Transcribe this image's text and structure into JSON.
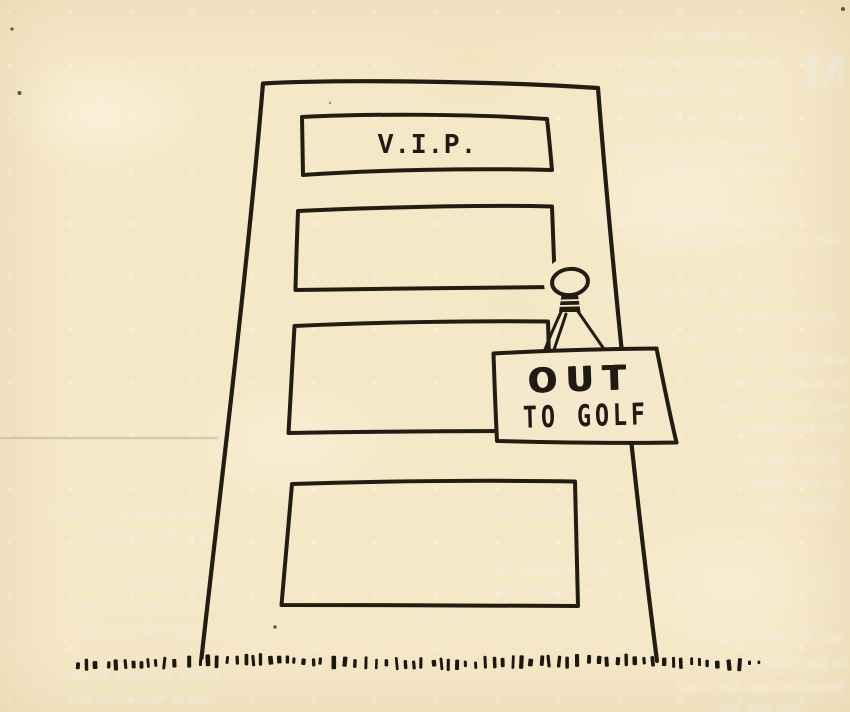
{
  "colors": {
    "paper": "#f5e8c7",
    "ink": "#221d14"
  },
  "door": {
    "vip_plate_label": "V.I.P.",
    "sign_line1": "OUT",
    "sign_line2": "TO GOLF",
    "panels_count": 4
  },
  "ghost_text": {
    "illegible": true,
    "big_letter": "M",
    "lines": [
      {
        "x": 598,
        "y": 28,
        "w": 150,
        "t": "um dem nach"
      },
      {
        "x": 612,
        "y": 54,
        "w": 168,
        "t": "geneinen versprinst"
      },
      {
        "x": 578,
        "y": 82,
        "w": 162,
        "t": "dep Vereing Beh"
      },
      {
        "x": 596,
        "y": 110,
        "w": 182,
        "t": "wenn ihr am Ein"
      },
      {
        "x": 576,
        "y": 138,
        "w": 225,
        "t": "gewohnt. Mitbewerb und"
      },
      {
        "x": 590,
        "y": 162,
        "w": 198,
        "t": "von der zum Ruf"
      },
      {
        "x": 445,
        "y": 210,
        "w": 360,
        "t": "worde. Wochenende seinz"
      },
      {
        "x": 560,
        "y": 232,
        "w": 282,
        "t": "dier ein Teil der Gesolchaft"
      },
      {
        "x": 462,
        "y": 286,
        "w": 332,
        "t": "fur den ein Viel der gesehende"
      },
      {
        "x": 620,
        "y": 309,
        "w": 216,
        "t": "ein Sekretarin vor"
      },
      {
        "x": 540,
        "y": 330,
        "w": 172,
        "t": "was der Gold"
      },
      {
        "x": 688,
        "y": 352,
        "w": 158,
        "t": "wie Glend die wohl"
      },
      {
        "x": 688,
        "y": 376,
        "w": 158,
        "t": "im nachgine echt"
      },
      {
        "x": 690,
        "y": 399,
        "w": 156,
        "t": "sein werden. Wenn"
      },
      {
        "x": 692,
        "y": 421,
        "w": 152,
        "t": "der kompliziert"
      },
      {
        "x": 690,
        "y": 452,
        "w": 148,
        "t": "Brief und der"
      },
      {
        "x": 692,
        "y": 475,
        "w": 150,
        "t": "zu viel, denn"
      },
      {
        "x": 690,
        "y": 498,
        "w": 145,
        "t": "gegen Sieg"
      },
      {
        "x": 415,
        "y": 505,
        "w": 240,
        "t": "und einem Gehale der"
      },
      {
        "x": 420,
        "y": 562,
        "w": 190,
        "t": "der Schmenn des"
      },
      {
        "x": 430,
        "y": 583,
        "w": 170,
        "t": "und Glond der ein"
      },
      {
        "x": 6,
        "y": 505,
        "w": 212,
        "t": "Angenommen, Sie hatt"
      },
      {
        "x": 10,
        "y": 528,
        "w": 198,
        "t": "gen Ihre wecker ge"
      },
      {
        "x": 2,
        "y": 575,
        "w": 222,
        "t": "hatte solchen wie ein"
      },
      {
        "x": 6,
        "y": 598,
        "w": 208,
        "t": "A fact, dass wir ein"
      },
      {
        "x": 2,
        "y": 622,
        "w": 218,
        "t": "bis zu und ders am"
      },
      {
        "x": 4,
        "y": 668,
        "w": 215,
        "t": "keine Termine da hor"
      },
      {
        "x": 8,
        "y": 692,
        "w": 202,
        "t": "dorm Woche an der"
      },
      {
        "x": 620,
        "y": 630,
        "w": 222,
        "t": "mit der ihr Vorgesetz"
      },
      {
        "x": 622,
        "y": 655,
        "w": 225,
        "t": "in der Schwimm und"
      },
      {
        "x": 618,
        "y": 680,
        "w": 227,
        "t": "Wermien und der Gold"
      },
      {
        "x": 640,
        "y": 700,
        "w": 160,
        "t": "der zun am"
      }
    ]
  }
}
